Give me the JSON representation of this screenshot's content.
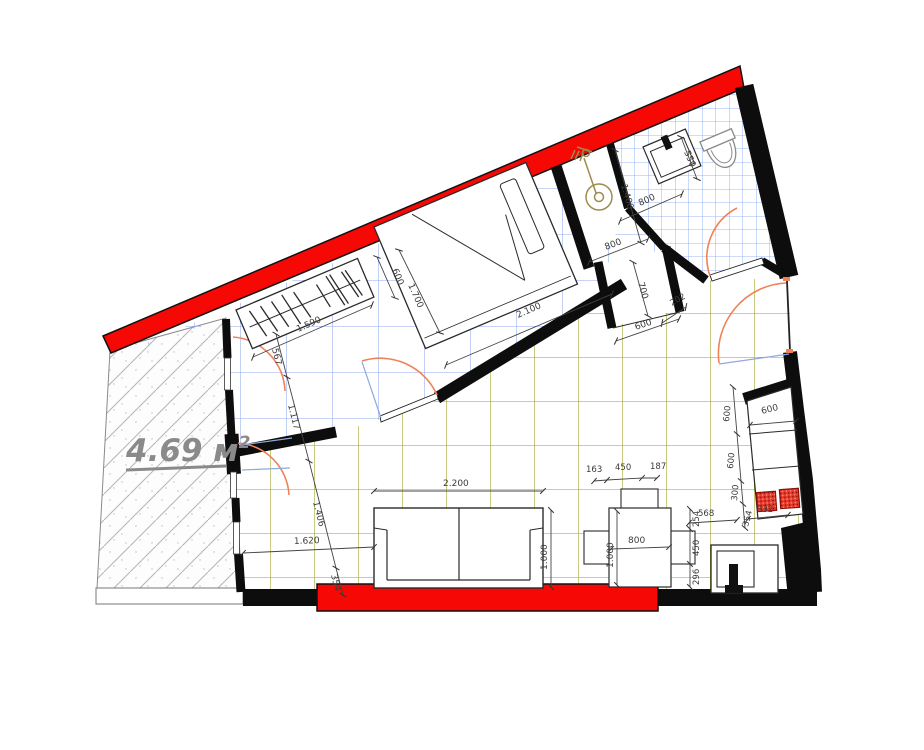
{
  "plan": {
    "area_label": {
      "value": "4.69 м",
      "sup": "2"
    },
    "colors": {
      "highlight_red": "#f60905",
      "wall": "#0d0d0d",
      "grid_living": "#9aa11b",
      "grid_room": "#8fa8ee",
      "grid_bath": "#7ba3f2",
      "door_arc": "#f08258",
      "door_leaf": "#90a8e0",
      "dim_text": "#3c3c3c",
      "area_text": "#8a8a8a",
      "shower_fixture": "#9c8d4e",
      "burner": "#e8392b"
    },
    "dimensions": {
      "balcony_chain": [
        "567",
        "1.117",
        "1.406",
        "354"
      ],
      "wardrobe": {
        "width": "1.590",
        "depth": "600"
      },
      "bed": {
        "width": "1.700",
        "length": "2.100"
      },
      "shower_room": {
        "length": "1.400",
        "width": "800"
      },
      "wc": {
        "toilet": "550",
        "basin": "800"
      },
      "hall": {
        "closet_depth": "700",
        "gap": "202",
        "closet_width": "600"
      },
      "sofa": {
        "length": "2.200",
        "offset_left": "1.620",
        "depth": "1.000"
      },
      "table": {
        "top_chain": [
          "163",
          "450",
          "187"
        ],
        "width": "800",
        "depth": "1.000",
        "right_chain": [
          "254",
          "450",
          "296"
        ]
      },
      "kitchen": {
        "counter_width": "600",
        "chain": [
          "600",
          "600",
          "300",
          "354"
        ],
        "sink_width": "568",
        "cooktop_width": "332"
      }
    }
  }
}
